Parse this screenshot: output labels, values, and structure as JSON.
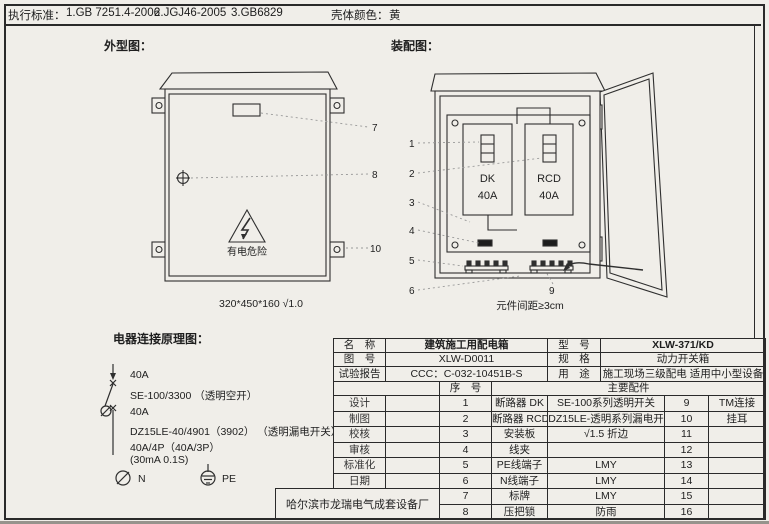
{
  "top_bar": {
    "standards_label": "执行标准：",
    "standard_1": "1.GB 7251.4-2006",
    "standard_2": "2.JGJ46-2005",
    "standard_3": "3.GB6829",
    "shell_color_label": "壳体颜色：",
    "shell_color_value": "黄"
  },
  "outline": {
    "title": "外型图：",
    "warning_text": "有电危险",
    "caption": "320*450*160 √1.0",
    "leader_7": "7",
    "leader_8": "8",
    "leader_10": "10"
  },
  "assembly": {
    "title": "装配图：",
    "breaker_dk": {
      "line1": "DK",
      "line2": "40A"
    },
    "breaker_rcd": {
      "line1": "RCD",
      "line2": "40A"
    },
    "caption": "元件间距≥3cm",
    "leaders": [
      "1",
      "2",
      "3",
      "4",
      "5",
      "6",
      "9"
    ]
  },
  "schematic": {
    "title": "电器连接原理图：",
    "lines": [
      "40A",
      "SE-100/3300 （透明空开）",
      "40A",
      "DZ15LE-40/4901（3902） （透明漏电开关）",
      "40A/4P（40A/3P）",
      "(30mA 0.1S)"
    ],
    "n_label": "N",
    "pe_label": "PE"
  },
  "title_block": {
    "rows": [
      {
        "label": "名　称",
        "value": "建筑施工用配电箱",
        "label2": "型　号",
        "value2": "XLW-371/KD"
      },
      {
        "label": "图　号",
        "value": "XLW-D0011",
        "label2": "规　格",
        "value2": "动力开关箱"
      },
      {
        "label": "试验报告",
        "value": "CCC：C-032-10451B-S",
        "label2": "用　途",
        "value2": "施工现场三级配电 适用中小型设备"
      }
    ],
    "seq_header": "序　号",
    "parts_header": "主要配件",
    "sign_labels": [
      "设计",
      "制图",
      "校核",
      "审核",
      "标准化",
      "日期"
    ],
    "items": [
      {
        "no": "1",
        "name": "断路器 DK",
        "spec": "SE-100系列透明开关",
        "no2": "9",
        "name2": "TM连接"
      },
      {
        "no": "2",
        "name": "断路器 RCD",
        "spec": "DZ15LE-透明系列漏电开",
        "no2": "10",
        "name2": "挂耳"
      },
      {
        "no": "3",
        "name": "安装板",
        "spec": "√1.5 折边",
        "no2": "11",
        "name2": ""
      },
      {
        "no": "4",
        "name": "线夹",
        "spec": "",
        "no2": "12",
        "name2": ""
      },
      {
        "no": "5",
        "name": "PE线端子",
        "spec": "LMY",
        "no2": "13",
        "name2": ""
      },
      {
        "no": "6",
        "name": "N线端子",
        "spec": "LMY",
        "no2": "14",
        "name2": ""
      },
      {
        "no": "7",
        "name": "标牌",
        "spec": "LMY",
        "no2": "15",
        "name2": ""
      },
      {
        "no": "8",
        "name": "压把锁",
        "spec": "防雨",
        "no2": "16",
        "name2": ""
      }
    ],
    "manufacturer": "哈尔滨市龙瑞电气成套设备厂"
  }
}
